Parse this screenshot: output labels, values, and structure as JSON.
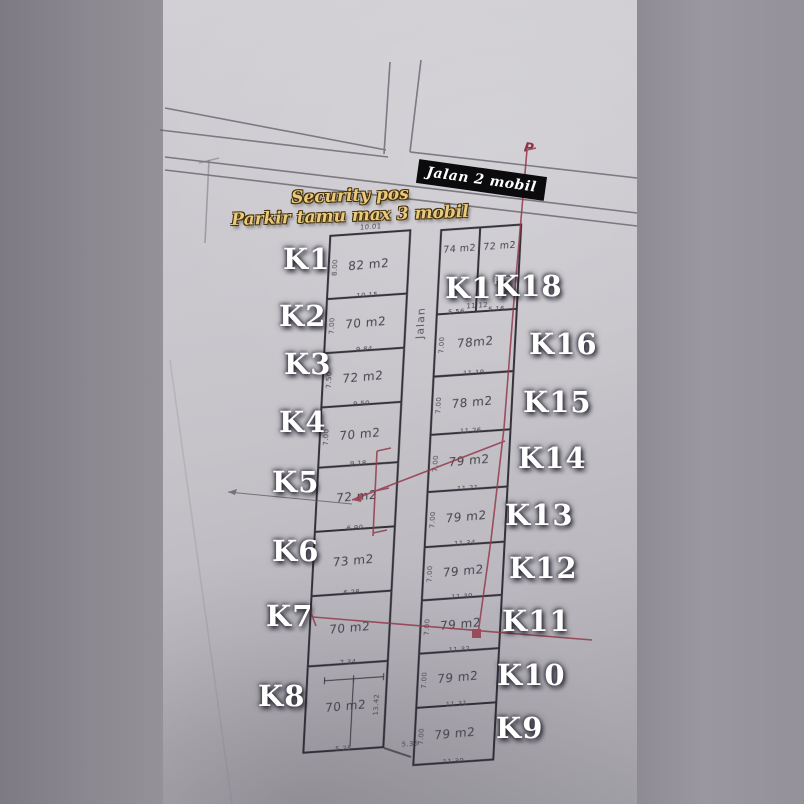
{
  "photo_overlay": {
    "badge": "Jalan 2 mobil",
    "caption": [
      "Security pos",
      "Parkir tamu max 3 mobil"
    ],
    "road_vertical_label": "Jalan",
    "red_mark": "P"
  },
  "plan": {
    "left_column": [
      {
        "id": "K1",
        "area": "82 m2",
        "top_dim": "10.01",
        "bottom_dim": "10.15",
        "left_dim": "8.00"
      },
      {
        "id": "K2",
        "area": "70 m2",
        "bottom_dim": "9.84",
        "left_dim": "7.00"
      },
      {
        "id": "K3",
        "area": "72 m2",
        "bottom_dim": "9.50",
        "left_dim": "7.50"
      },
      {
        "id": "K4",
        "area": "70 m2",
        "bottom_dim": "9.18",
        "left_dim": "7.00"
      },
      {
        "id": "K5",
        "area": "72 m2",
        "bottom_dim": "6.90"
      },
      {
        "id": "K6",
        "area": "73 m2",
        "bottom_dim": "6.28"
      },
      {
        "id": "K7",
        "area": "70 m2",
        "bottom_dim": "7.34"
      },
      {
        "id": "K8",
        "area": "70 m2",
        "bottom_dim": "5.25",
        "extra_bottom_dim": "5.36",
        "right_dim": "13.42"
      }
    ],
    "top_right_pair": [
      {
        "id": "K17",
        "area": "74 m2",
        "bottom_dim": "5.56"
      },
      {
        "id": "K18",
        "area": "72 m2",
        "bottom_dim": "5.16"
      }
    ],
    "right_column": [
      {
        "id": "K16",
        "area": "78m2",
        "top_dim": "11.12",
        "bottom_dim": "11.19",
        "left_dim": "7.00"
      },
      {
        "id": "K15",
        "area": "78 m2",
        "bottom_dim": "11.26",
        "left_dim": "7.00"
      },
      {
        "id": "K14",
        "area": "79 m2",
        "bottom_dim": "11.21",
        "left_dim": "7.00"
      },
      {
        "id": "K13",
        "area": "79 m2",
        "bottom_dim": "11.34",
        "left_dim": "7.00"
      },
      {
        "id": "K12",
        "area": "79 m2",
        "bottom_dim": "11.30",
        "left_dim": "7.00"
      },
      {
        "id": "K11",
        "area": "79 m2",
        "bottom_dim": "11.32",
        "left_dim": "7.00"
      },
      {
        "id": "K10",
        "area": "79 m2",
        "bottom_dim": "11.31",
        "left_dim": "7.00"
      },
      {
        "id": "K9",
        "area": "79 m2",
        "bottom_dim": "11.30",
        "left_dim": "7.00"
      }
    ]
  },
  "colors": {
    "paper": "#c8c6cb",
    "margin": "#8f8c93",
    "plan_line": "#343239",
    "red_annotation": "#933a4c",
    "label_white": "#ffffff",
    "caption_gold": "#e9c97e",
    "badge_bg": "#0b0a0c",
    "badge_text": "#ffffff"
  }
}
